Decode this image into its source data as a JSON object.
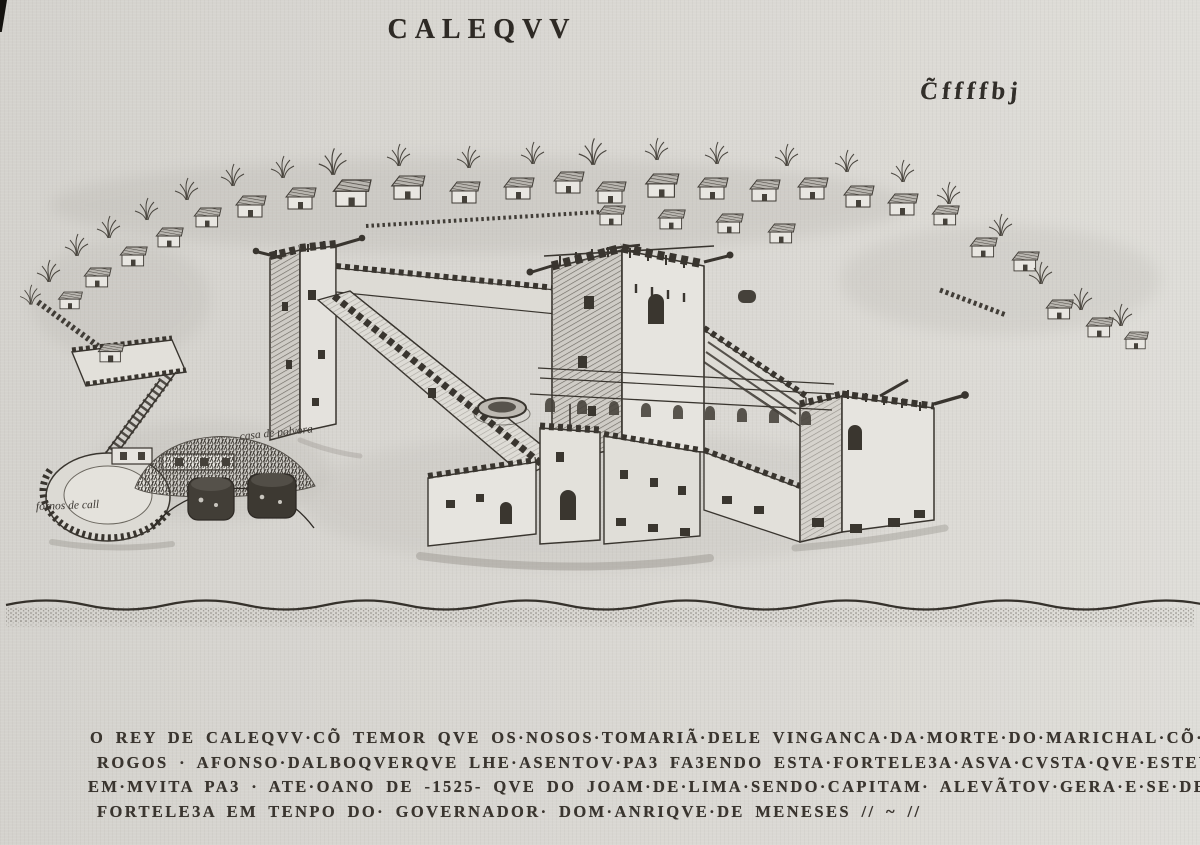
{
  "page": {
    "title": "CALEQVV",
    "folio_mark": "C̃ffffbj"
  },
  "annotations": {
    "powder_house_label": "casa de polvora",
    "lime_kilns_label": "fornos de call"
  },
  "caption": {
    "lines": [
      "O REY DE CALEQVV·CÕ TEMOR QVE OS·NOSOS·TOMARIÃ·DELE VINGANCA·DA·MORTE·DO·MARICHAL·CÕ·MVITO",
      "ROGOS · AFONSO·DALBOQVERQVE LHE·ASENTOV·PA3 FA3ENDO ESTA·FORTELE3A·ASVA·CVSTA·QVE·ESTEV",
      "EM·MVITA PA3 · ATE·OANO DE -1525- QVE DO JOAM·DE·LIMA·SENDO·CAPITAM· ALEVÃTOV·GERA·E·SE·DESFE3 ES",
      "FORTELE3A EM TENPO DO· GOVERNADOR· DOM·ANRIQVE·DE MENESES // ~ //"
    ]
  },
  "colors": {
    "paper": "#d8d6d1",
    "ink": "#39352f",
    "shade": "#6e6a63"
  }
}
